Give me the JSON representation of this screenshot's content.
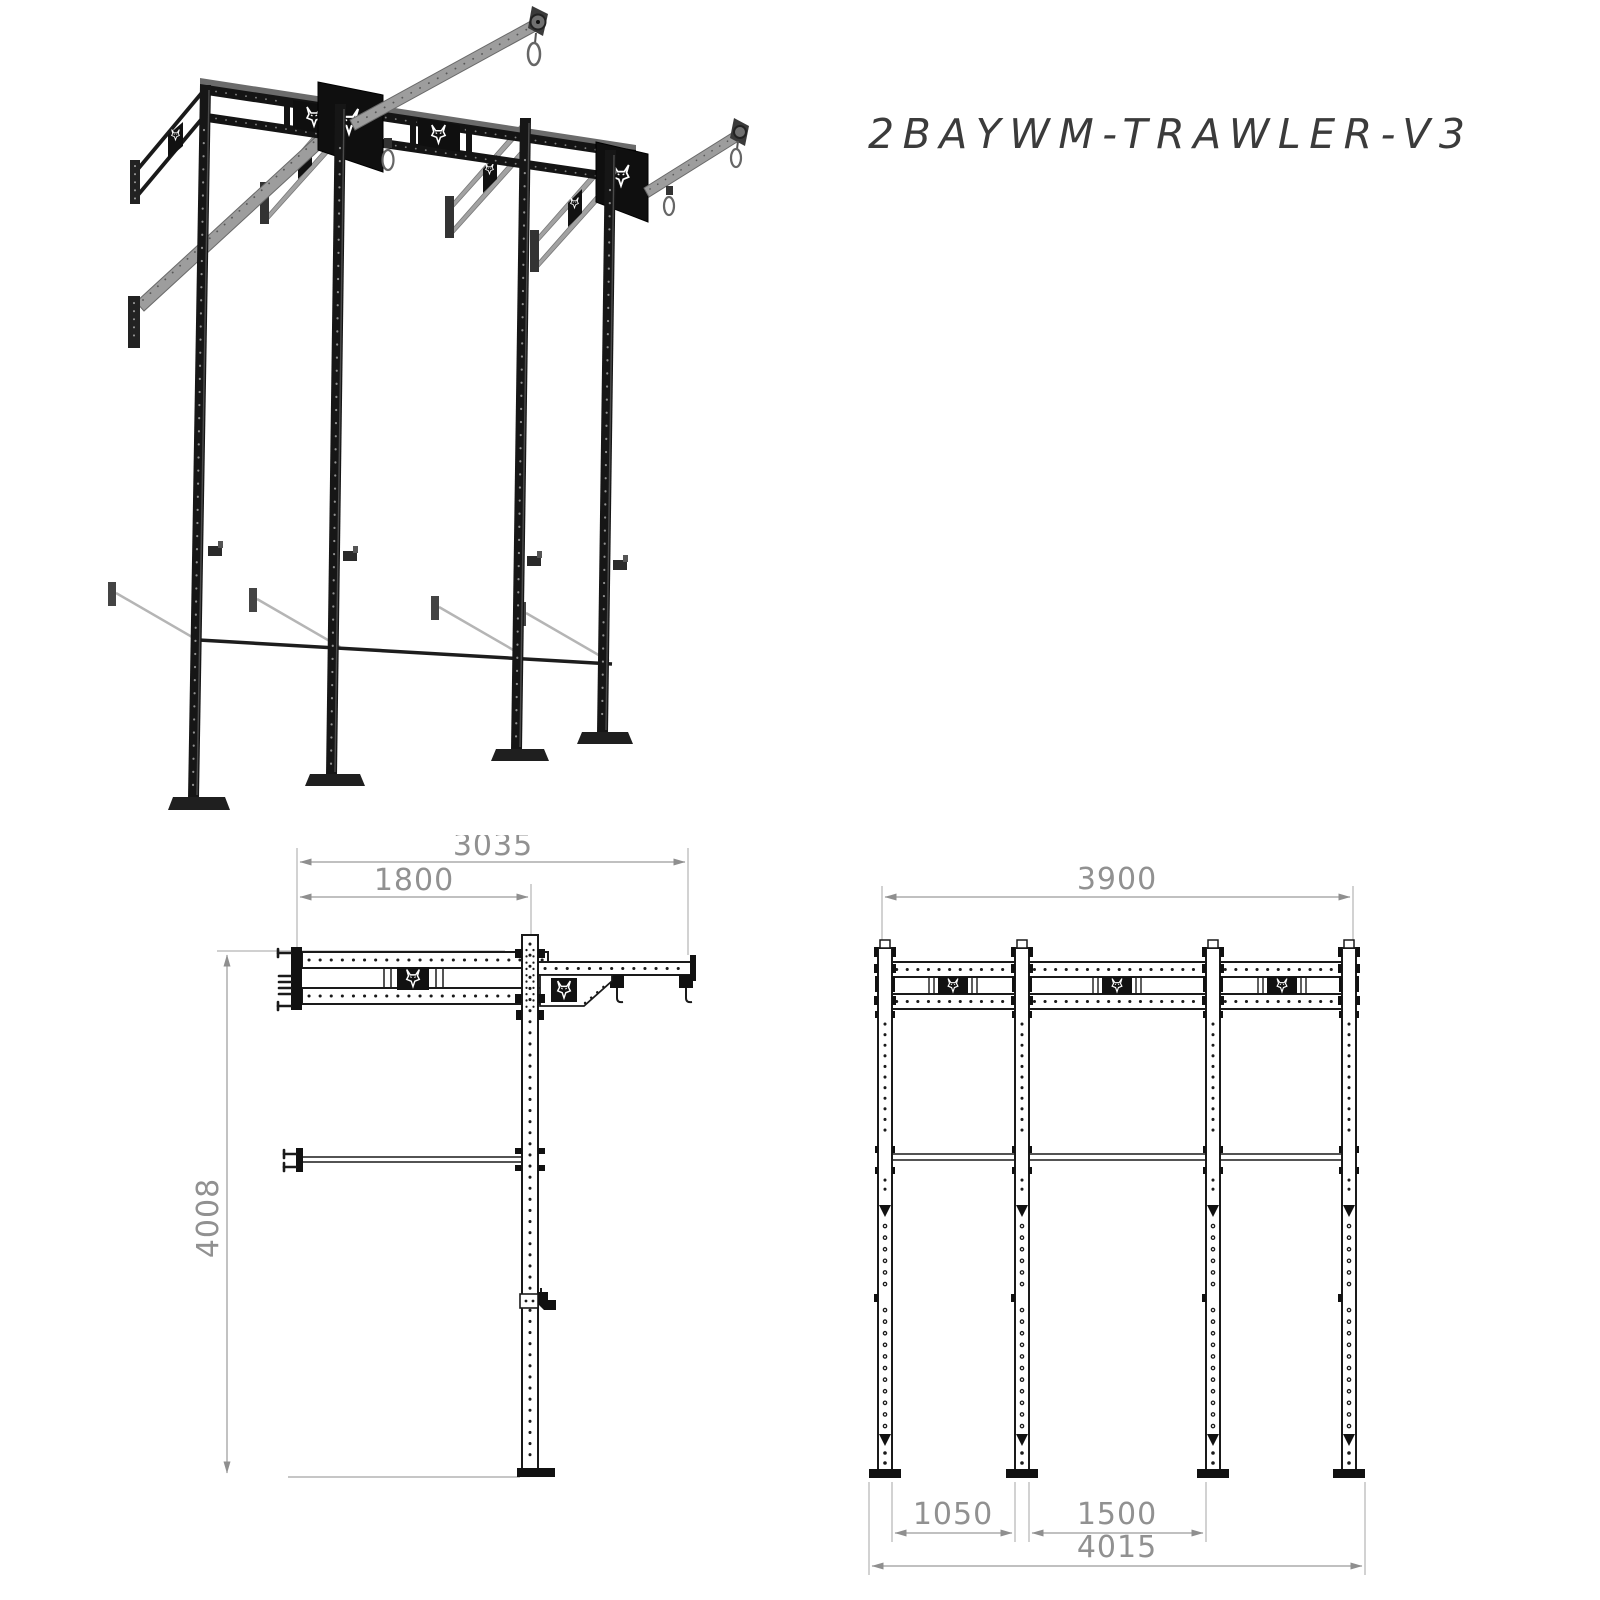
{
  "title": "2BAYWM-TRAWLER-V3",
  "brand": {
    "logo_icon": "wolf-head"
  },
  "colors": {
    "ink": "#1a1a1a",
    "steel_gray": "#9d9d9d",
    "dimension_gray": "#919191",
    "extension_gray": "#b3b3b3",
    "background": "#ffffff"
  },
  "side_view": {
    "dim_total_depth": "3035",
    "dim_wall_to_post": "1800",
    "dim_height": "4008"
  },
  "front_view": {
    "dim_beam_length": "3900",
    "dim_bay_left": "1050",
    "dim_bay_right": "1500",
    "dim_total_width": "4015"
  }
}
